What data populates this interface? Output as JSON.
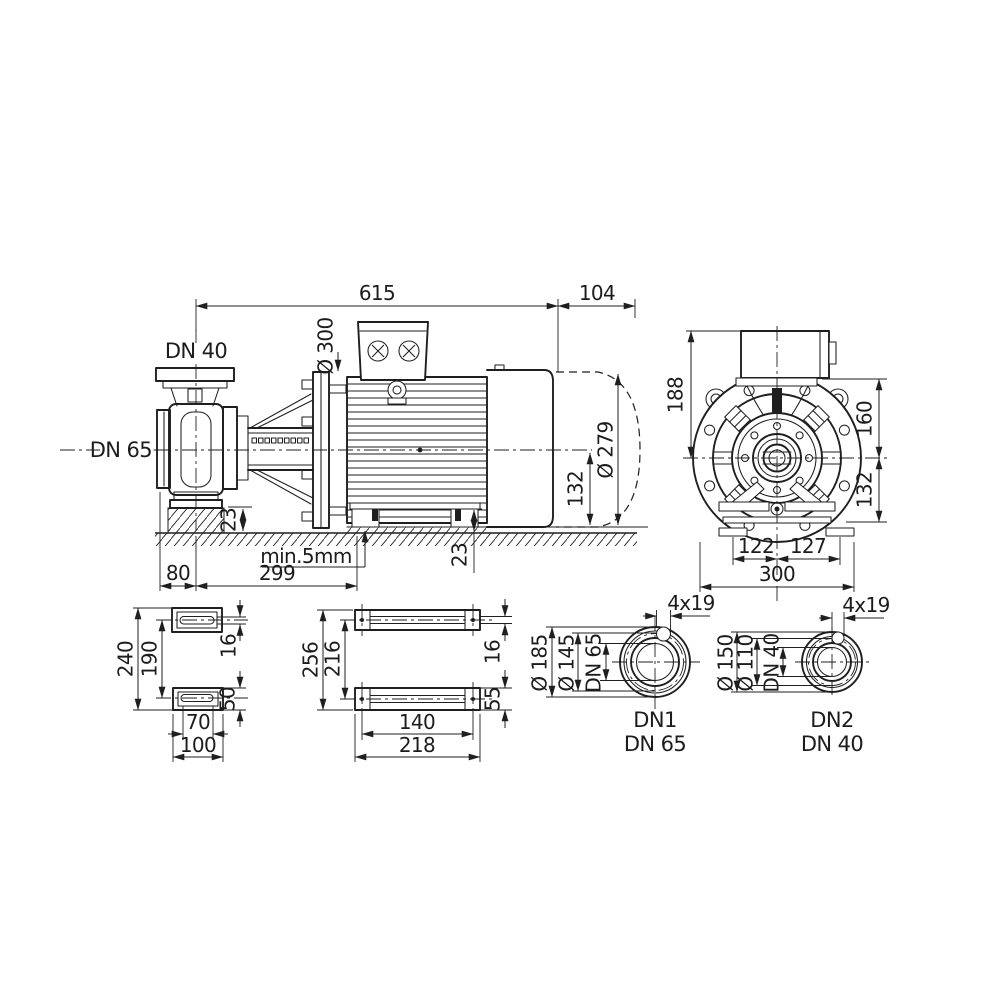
{
  "side_view": {
    "len_total": "615",
    "len_fan": "104",
    "dia_flange": "Ø 300",
    "port_top": "DN 40",
    "port_side": "DN 65",
    "dia_motor": "Ø 279",
    "h_center_to_base": "132",
    "h_pump_foot": "23",
    "h_motor_foot": "23",
    "grout_note": "min.5mm",
    "off_pump_foot": "80",
    "span_feet": "299"
  },
  "end_view": {
    "h_box_to_center": "188",
    "h_flange_to_center": "160",
    "h_center_to_foot": "132",
    "foot_left": "122",
    "foot_right": "127",
    "width_total": "300"
  },
  "pump_foot_plan": {
    "depth_total": "240",
    "hole_pitch": "190",
    "slot_width": "16",
    "pad_width": "50",
    "hole_span": "70",
    "pad_length": "100"
  },
  "motor_foot_plan": {
    "depth_total": "256",
    "hole_pitch": "216",
    "slot_width": "16",
    "pad_width": "55",
    "hole_span": "140",
    "pad_length": "218"
  },
  "flange_dn1": {
    "dia_outer": "Ø 185",
    "dia_bolt_circle": "Ø 145",
    "bore": "DN 65",
    "holes": "4x19",
    "name": "DN1",
    "size": "DN 65"
  },
  "flange_dn2": {
    "dia_outer": "Ø 150",
    "dia_bolt_circle": "Ø 110",
    "bore": "DN 40",
    "holes": "4x19",
    "name": "DN2",
    "size": "DN 40"
  }
}
